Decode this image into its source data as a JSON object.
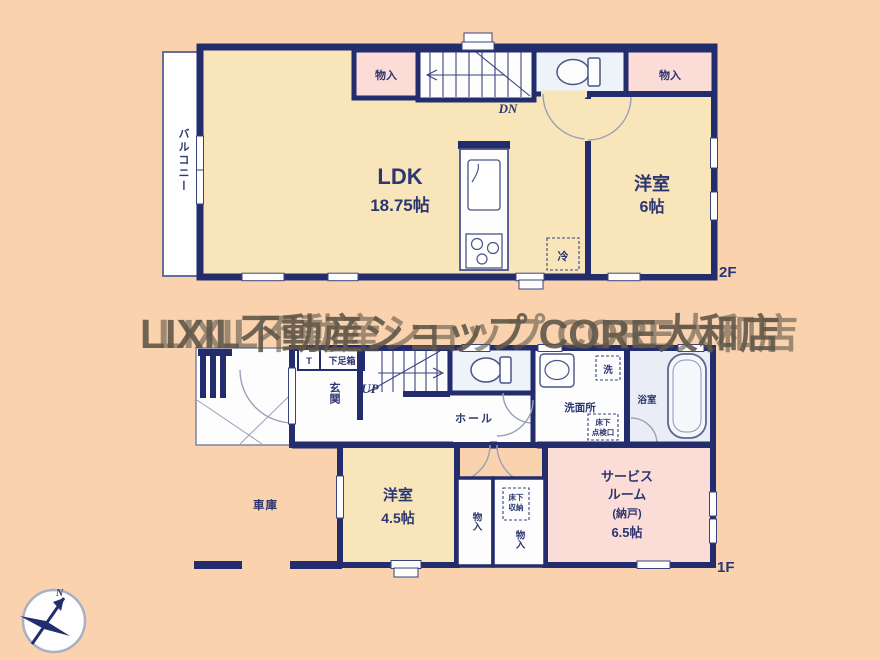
{
  "watermark": {
    "text": "LIXIL不動産ショップ CORE大和店"
  },
  "floor2": {
    "label": "2F",
    "balcony": "バルコニー",
    "ldk_name": "LDK",
    "ldk_size": "18.75帖",
    "closet_left": "物入",
    "closet_right": "物入",
    "stairs_down": "DN",
    "room_name": "洋室",
    "room_size": "6帖",
    "fridge": "冷"
  },
  "floor1": {
    "label": "1F",
    "entrance": "玄関",
    "shoe_mark": "T",
    "shoe_box": "下足箱",
    "stairs_up": "UP",
    "hall": "ホール",
    "washroom": "洗面所",
    "washer": "洗",
    "hatch_line1": "床下",
    "hatch_line2": "点検口",
    "bathroom": "浴室",
    "garage": "車庫",
    "room_name": "洋室",
    "room_size": "4.5帖",
    "closet_a": "物入",
    "closet_b": "物入",
    "storage_line1": "床下",
    "storage_line2": "収納",
    "service_line1": "サービス",
    "service_line2": "ルーム",
    "service_line3": "(納戸)",
    "service_line4": "6.5帖"
  },
  "compass": {
    "north": "N"
  },
  "colors": {
    "background": "#fbd2ae",
    "wall": "#232d6e",
    "room_yellow": "#f8e6ba",
    "room_pink": "#fbdcd6",
    "room_white": "#fdfdfe",
    "room_bath": "#e9eef6",
    "label_text": "#2c3670",
    "watermark": "#60584a"
  }
}
